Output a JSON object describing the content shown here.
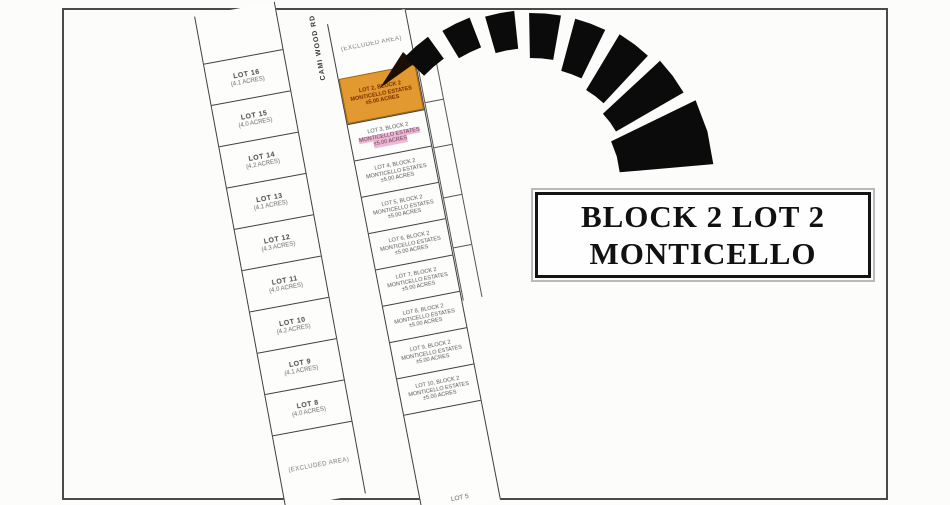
{
  "colors": {
    "highlight_lot_fill": "#e2992f",
    "highlight_lot_border": "#a5640a",
    "pink_highlight": "#eeb7d4",
    "arrow": "#0b0b0b",
    "frame_line": "#4a4a4a",
    "parcel_line": "#3f3f3f"
  },
  "map": {
    "road_label": "CAMI WOOD RD",
    "excluded_area_top": "(EXCLUDED AREA)",
    "excluded_area_bottom": "(EXCLUDED AREA)",
    "left_lots": [
      {
        "name": "LOT 16",
        "sub": "(4.1 ACRES)"
      },
      {
        "name": "LOT 15",
        "sub": "(4.0 ACRES)"
      },
      {
        "name": "LOT 14",
        "sub": "(4.2 ACRES)"
      },
      {
        "name": "LOT 13",
        "sub": "(4.1 ACRES)"
      },
      {
        "name": "LOT 12",
        "sub": "(4.3 ACRES)"
      },
      {
        "name": "LOT 11",
        "sub": "(4.0 ACRES)"
      },
      {
        "name": "LOT 10",
        "sub": "(4.2 ACRES)"
      },
      {
        "name": "LOT 9",
        "sub": "(4.1 ACRES)"
      },
      {
        "name": "LOT 8",
        "sub": "(4.0 ACRES)"
      }
    ],
    "right_lots": [
      {
        "line1": "LOT 2, BLOCK 2",
        "line2": "MONTICELLO ESTATES",
        "line3": "±5.00 ACRES",
        "highlight": "orange"
      },
      {
        "line1": "LOT 3, BLOCK 2",
        "line2": "MONTICELLO ESTATES",
        "line3": "±5.00 ACRES",
        "highlight": "pink"
      },
      {
        "line1": "LOT 4, BLOCK 2",
        "line2": "MONTICELLO ESTATES",
        "line3": "±5.00 ACRES"
      },
      {
        "line1": "LOT 5, BLOCK 2",
        "line2": "MONTICELLO ESTATES",
        "line3": "±5.00 ACRES"
      },
      {
        "line1": "LOT 6, BLOCK 2",
        "line2": "MONTICELLO ESTATES",
        "line3": "±5.00 ACRES"
      },
      {
        "line1": "LOT 7, BLOCK 2",
        "line2": "MONTICELLO ESTATES",
        "line3": "±5.00 ACRES"
      },
      {
        "line1": "LOT 8, BLOCK 2",
        "line2": "MONTICELLO ESTATES",
        "line3": "±5.00 ACRES"
      },
      {
        "line1": "LOT 9, BLOCK 2",
        "line2": "MONTICELLO ESTATES",
        "line3": "±5.00 ACRES"
      },
      {
        "line1": "LOT 10, BLOCK 2",
        "line2": "MONTICELLO ESTATES",
        "line3": "±5.00 ACRES"
      }
    ],
    "bottom_right_lot": "LOT 5"
  },
  "callout": {
    "line1": "BLOCK 2 LOT 2",
    "line2": "MONTICELLO"
  }
}
